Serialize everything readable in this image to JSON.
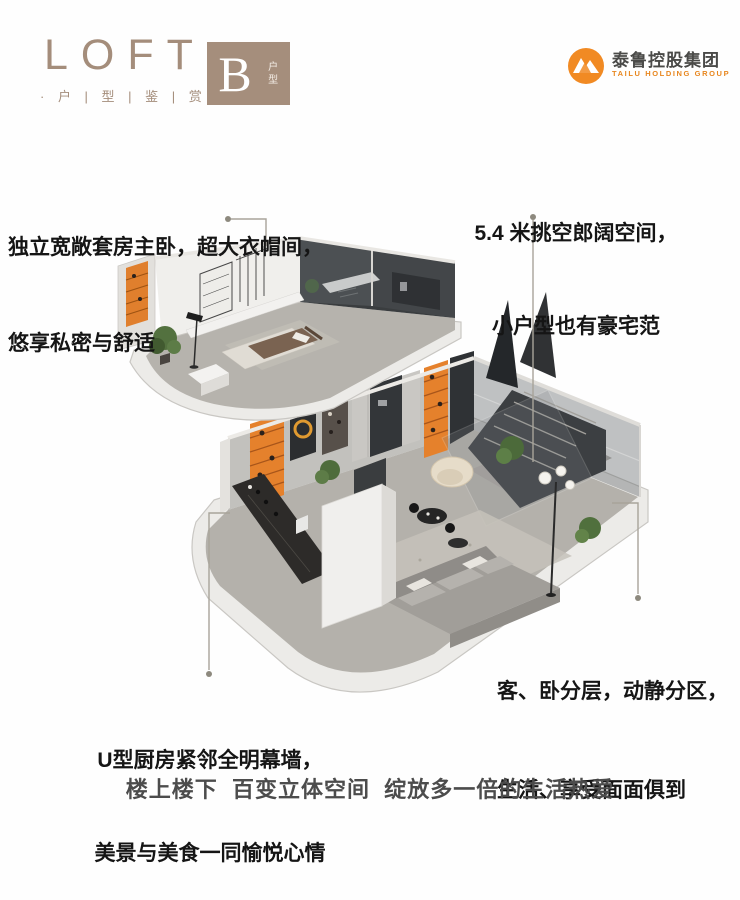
{
  "header": {
    "brand": "LOFT",
    "brand_sub": "· 户 | 型 | 鉴 | 赏 ·",
    "unit_letter": "B",
    "unit_label": "户型",
    "company_name": "泰鲁控股集团",
    "company_name_en": "TAILU HOLDING GROUP"
  },
  "annotations": {
    "master_bedroom": {
      "line1": "独立宽敞套房主卧，超大衣帽间，",
      "line2": "悠享私密与舒适"
    },
    "double_height": {
      "line1": "5.4 米挑空郎阔空间，",
      "line2": "小户型也有豪宅范"
    },
    "zoning": {
      "line1": "客、卧分层，动静分区，",
      "line2": "生活、享受面面俱到"
    },
    "kitchen": {
      "line1": "U型厨房紧邻全明幕墙，",
      "line2": "美景与美食一同愉悦心情"
    }
  },
  "tagline": "楼上楼下  百变立体空间  绽放多一倍的生活热爱",
  "colors": {
    "accent_taupe": "#a48d7b",
    "accent_orange": "#e5812c",
    "logo_orange": "#f18a23",
    "text_dark": "#151515",
    "tagline_gray": "#4c4c4c",
    "connector_gray": "#a8a49a",
    "charcoal": "#3a3d3f"
  }
}
